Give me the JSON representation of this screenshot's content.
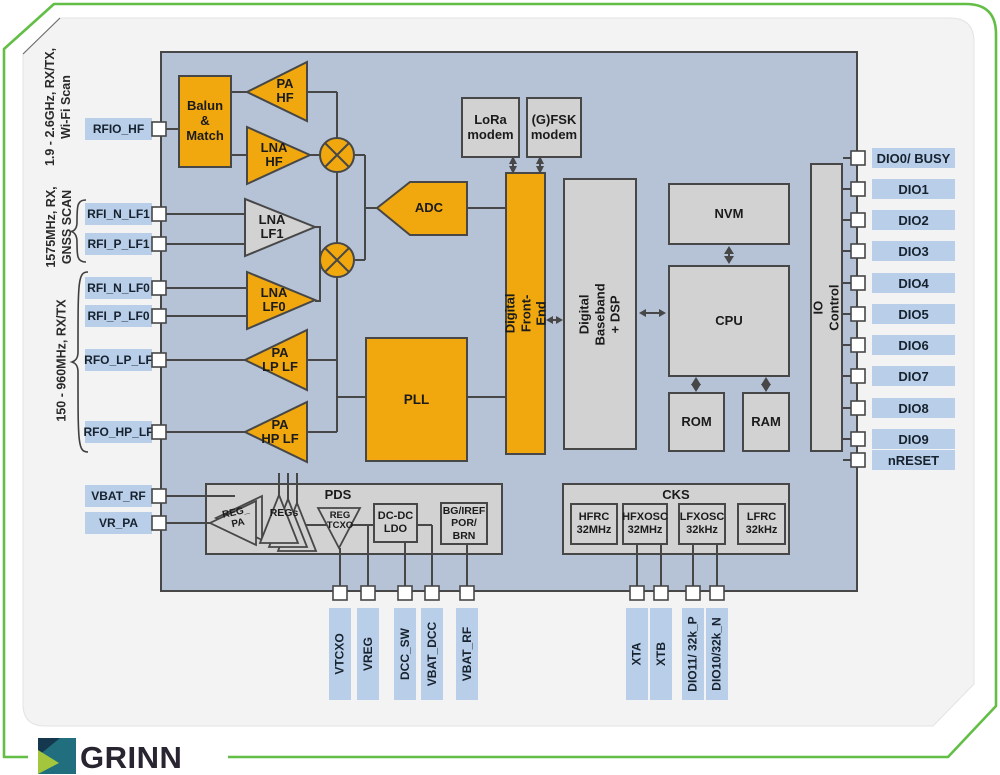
{
  "footer": {
    "brand": "GRINN"
  },
  "colors": {
    "accent_green": "#63BE46",
    "block_orange": "#F0A80E",
    "block_gray": "#D2D2D2",
    "diagram_bg": "#B6C2D6",
    "pin_label_bg": "#B9CFE9",
    "line": "#474747",
    "logo_teal": "#206E7E",
    "logo_navy": "#16384E",
    "logo_green": "#A3C63C"
  },
  "diagram": {
    "left_groups": [
      {
        "caption": "1.9 - 2.6GHz, RX/TX,\nWi-Fi Scan"
      },
      {
        "caption": "1575MHz, RX,\nGNSS SCAN"
      },
      {
        "caption": "150 - 960MHz, RX/TX"
      }
    ],
    "left_pins": [
      "RFIO_HF",
      "RFI_N_LF1",
      "RFI_P_LF1",
      "RFI_N_LF0",
      "RFI_P_LF0",
      "RFO_LP_LF",
      "RFO_HP_LF",
      "VBAT_RF",
      "VR_PA"
    ],
    "right_pins": [
      "DIO0/ BUSY",
      "DIO1",
      "DIO2",
      "DIO3",
      "DIO4",
      "DIO5",
      "DIO6",
      "DIO7",
      "DIO8",
      "DIO9",
      "nRESET"
    ],
    "bottom_pins": [
      "VTCXO",
      "VREG",
      "DCC_SW",
      "VBAT_DCC",
      "VBAT_RF",
      "XTA",
      "XTB",
      "DIO11/ 32k_P",
      "DIO10/32k_N"
    ],
    "blocks": {
      "balun": "Balun\n&\nMatch",
      "pa_hf": "PA\nHF",
      "lna_hf": "LNA\nHF",
      "lna_lf1": "LNA\nLF1",
      "lna_lf0": "LNA\nLF0",
      "pa_lp_lf": "PA\nLP LF",
      "pa_hp_lf": "PA\nHP LF",
      "adc": "ADC",
      "pll": "PLL",
      "dfe": "Digital Front-End",
      "lora": "LoRa\nmodem",
      "gfsk": "(G)FSK\nmodem",
      "dbb": "Digital Baseband\n+ DSP",
      "nvm": "NVM",
      "cpu": "CPU",
      "rom": "ROM",
      "ram": "RAM",
      "io_control": "IO Control"
    },
    "pds": {
      "title": "PDS",
      "reg_pa": "REG_\nPA",
      "regs": "REGs",
      "reg_tcxo": "REG\nTCXO",
      "dcdc_ldo": "DC-DC\nLDO",
      "bg_iref": "BG/IREF\nPOR/\nBRN"
    },
    "cks": {
      "title": "CKS",
      "oscillators": [
        "HFRC\n32MHz",
        "HFXOSC\n32MHz",
        "LFXOSC\n32kHz",
        "LFRC\n32kHz"
      ]
    }
  }
}
